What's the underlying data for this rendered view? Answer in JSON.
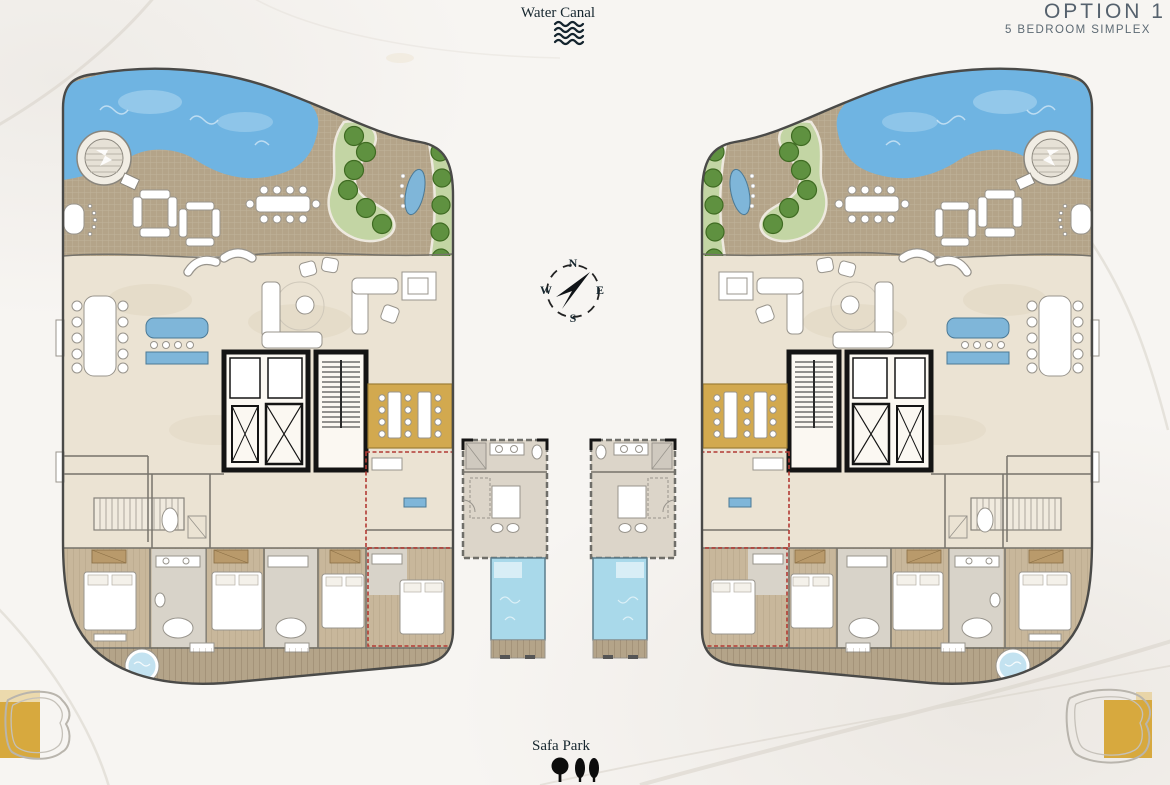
{
  "header": {
    "option": "OPTION 1",
    "subtitle": "5 BEDROOM SIMPLEX"
  },
  "landmarks": {
    "water_canal": "Water Canal",
    "safa_park": "Safa Park"
  },
  "compass": {
    "n": "N",
    "e": "E",
    "s": "S",
    "w": "W"
  },
  "icons": {
    "water_canal": "waves-icon",
    "safa_park": "park-trees-icon",
    "compass": "compass-rose-icon"
  },
  "colors": {
    "deck": "#b4a489",
    "wood": "#c8b79b",
    "marble": "#ebe3d3",
    "pool": "#6fb4e2",
    "plunge": "#a9d9ea",
    "spa": "#c3e2f0",
    "grass": "#c3d5a4",
    "tree": "#5f9140",
    "treedark": "#3f6b22",
    "gold": "#d2a94f",
    "counter": "#7fb6d9",
    "red": "#b23b34",
    "outline": "#4a4a48",
    "wall": "#76736b",
    "ink": "#16262e",
    "title": "#55616d",
    "crestgold": "#d7a93e"
  }
}
